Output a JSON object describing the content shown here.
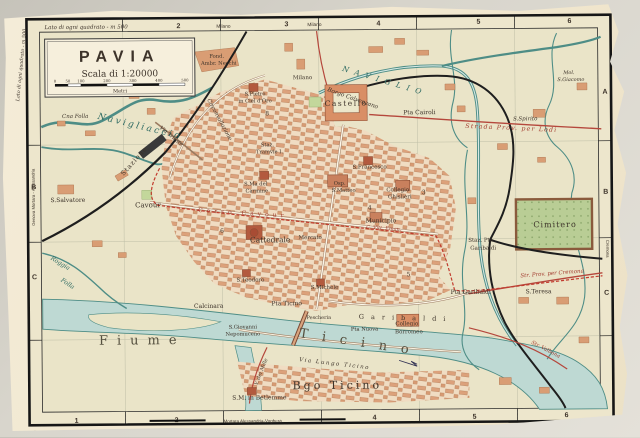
{
  "title_box": {
    "title": "PAVIA",
    "scale": "Scala di 1:20000",
    "ticks": [
      "0",
      "50",
      "100",
      "200",
      "300",
      "400",
      "500"
    ],
    "unit": "Metri"
  },
  "edge": {
    "square_note_top": "Lato di ogni quadrato - m 500",
    "square_note_left": "Lato di ogni quadrato - m 500",
    "credit_left": "PROPR. DEL T.C.I.   RIPROD. VIET.",
    "credit_right": "STAMPA - ANTONIO VALLARDI - MILANO",
    "rail_bottom": "Mortara Alessandria-Voghera",
    "rail_left": "Genova Mortara - Alessandria",
    "rail_right": "Cremona",
    "milano_1": "Milano",
    "milano_2": "Milano",
    "top_numbers": [
      "2",
      "3",
      "4",
      "5",
      "6"
    ],
    "bottom_numbers": [
      "1",
      "2",
      "4",
      "5",
      "6"
    ],
    "left_letters": [
      "B",
      "C"
    ],
    "right_letters": [
      "A",
      "B",
      "C"
    ]
  },
  "labels": {
    "navigliaccio": "Navigliaccio",
    "cna_folla": "Cna Folla",
    "roggia": "Roggia",
    "folla": "Folla",
    "s_salvatore": "S.Salvatore",
    "stazione": "Stazione",
    "fond_necchi_1": "Fond.",
    "fond_necchi_2": "Ambr. Necchi",
    "s_pietro_1": "S.Pietro",
    "s_pietro_2": "in Ciel d'Oro",
    "naviglio": "NAVIGLIO",
    "borgo_calvenzano": "Borgo Calvenzano",
    "milano_road": "Milano",
    "castello": "Castello",
    "pta_cairoli": "Pta Cairoli",
    "str_lodi": "Strada Prov. per Lodi",
    "mol_giacomo_1": "Mol.",
    "mol_giacomo_2": "S.Giacomo",
    "s_spirito": "S.Spirito",
    "cimitero": "Cimitero",
    "str_cremona": "Str. Prov. per Cremona",
    "s_teresa": "S.Teresa",
    "str_valbona": "Str. Valbona",
    "staz_garibaldi_1": "Staz. Pta",
    "staz_garibaldi_2": "Garibaldi",
    "pta_garibaldi": "Pta Garibaldi",
    "corso_garibaldi": "Garibaldi",
    "collegio_borromeo_1": "Collegio",
    "collegio_borromeo_2": "Borromeo",
    "pta_nuova": "Pta Nuova",
    "via_trieste": "Via Trieste",
    "circonvallazione": "Circonvallazione",
    "cavour": "Cavour",
    "corso_cavour": "Corso Cavour",
    "c_vitt_eman": "C. Vitt. Eman.",
    "staz_tramvie_1": "Staz.",
    "staz_tramvie_2": "Tramvie I.",
    "s_ma_carmine_1": "S.Ma del",
    "s_ma_carmine_2": "Carmine",
    "s_francesco": "S.Francesco",
    "osp_matteo_1": "Osp.",
    "osp_matteo_2": "S.Matteo",
    "collegio_ghislieri_1": "Collegio",
    "collegio_ghislieri_2": "Ghislieri",
    "municipio": "Municipio",
    "cattedrale": "Cattedrale",
    "mercato": "Mercato",
    "s_teodoro": "S.Teodoro",
    "s_michele": "S.Michele",
    "pta_ticino": "Pta Ticino",
    "calcinara": "Calcinara",
    "pescheria": "Pescheria",
    "s_giovanni_1": "S.Giovanni",
    "s_giovanni_2": "Nepomuceno",
    "viale_mille": "V. dei Mille",
    "via_lungo": "Via Lungo Ticino",
    "fiume": "Fiume",
    "ticino_river": "Ticino",
    "bgo_ticino": "Bgo Ticino",
    "s_m_betlemme": "S.M. in Betlemme"
  },
  "index_numbers": {
    "i3": "3",
    "i4": "4",
    "i5": "5",
    "i6": "6",
    "i8": "8"
  },
  "colors": {
    "paper": "#f1e9d4",
    "map_land": "#eae4c8",
    "water": "#bed9d3",
    "water_line": "#4e8d86",
    "buildings": "#dca17b",
    "building_dark": "#b35a3e",
    "road_red": "#b5473c",
    "railway": "#1e1e1e",
    "cemetery_green": "#b9cd95",
    "label_ink": "#3d332a"
  }
}
